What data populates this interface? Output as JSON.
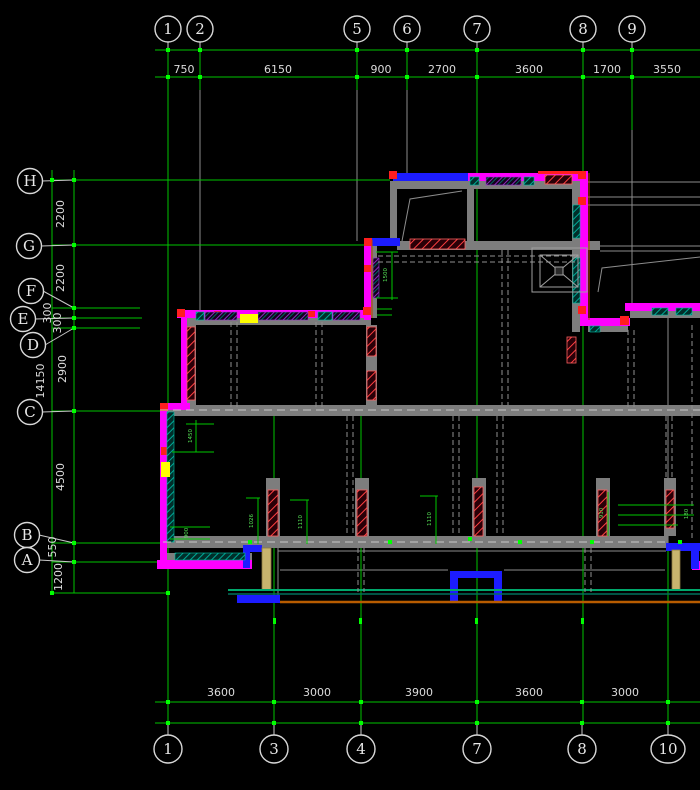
{
  "drawing": {
    "type": "cad-structural-floor-plan",
    "background": "#000000",
    "colors": {
      "grid_green": "#00C400",
      "marker_green": "#00FF00",
      "dim_text": "#DCDCDC",
      "wall_gray": "#7D7D7D",
      "outline_magenta": "#FF00FF",
      "accent_blue": "#1C1CFF",
      "accent_red": "#FF1E1E",
      "hatch_teal": "#00897B",
      "hatch_purple": "#7A00B4",
      "highlight_yellow": "#FFFF00",
      "edge_orange": "#B85C00",
      "door_tan": "#C8B46E"
    },
    "grid": {
      "top_bubbles": [
        {
          "label": "1",
          "x": 168
        },
        {
          "label": "2",
          "x": 200
        },
        {
          "label": "5",
          "x": 357
        },
        {
          "label": "6",
          "x": 407
        },
        {
          "label": "7",
          "x": 477
        },
        {
          "label": "8",
          "x": 583
        },
        {
          "label": "9",
          "x": 632
        }
      ],
      "bottom_bubbles": [
        {
          "label": "1",
          "x": 168
        },
        {
          "label": "3",
          "x": 274
        },
        {
          "label": "4",
          "x": 361
        },
        {
          "label": "7",
          "x": 477
        },
        {
          "label": "8",
          "x": 582
        },
        {
          "label": "10",
          "x": 668
        }
      ],
      "left_bubbles": [
        {
          "label": "H",
          "cx": 30,
          "cy": 181,
          "row_y": 180
        },
        {
          "label": "G",
          "cx": 29,
          "cy": 246,
          "row_y": 245
        },
        {
          "label": "F",
          "cx": 31,
          "cy": 291,
          "row_y": 308
        },
        {
          "label": "E",
          "cx": 23,
          "cy": 319,
          "row_y": 318
        },
        {
          "label": "D",
          "cx": 33,
          "cy": 345,
          "row_y": 328
        },
        {
          "label": "C",
          "cx": 30,
          "cy": 412,
          "row_y": 411
        },
        {
          "label": "B",
          "cx": 27,
          "cy": 535,
          "row_y": 543
        },
        {
          "label": "A",
          "cx": 27,
          "cy": 560,
          "row_y": 562
        }
      ],
      "top_dims": [
        {
          "value": "750",
          "x": 184
        },
        {
          "value": "6150",
          "x": 278
        },
        {
          "value": "900",
          "x": 381
        },
        {
          "value": "2700",
          "x": 442
        },
        {
          "value": "3600",
          "x": 529
        },
        {
          "value": "1700",
          "x": 607
        },
        {
          "value": "3550",
          "x": 667
        }
      ],
      "bottom_dims": [
        {
          "value": "3600",
          "x": 221
        },
        {
          "value": "3000",
          "x": 317
        },
        {
          "value": "3900",
          "x": 419
        },
        {
          "value": "3600",
          "x": 529
        },
        {
          "value": "3000",
          "x": 625
        }
      ],
      "left_dims": [
        {
          "value": "2200",
          "x": 64,
          "y": 214
        },
        {
          "value": "2200",
          "x": 64,
          "y": 278
        },
        {
          "value": "300",
          "x": 51,
          "y": 313
        },
        {
          "value": "300",
          "x": 61,
          "y": 323
        },
        {
          "value": "2900",
          "x": 66,
          "y": 369
        },
        {
          "value": "4500",
          "x": 64,
          "y": 477
        },
        {
          "value": "550",
          "x": 56,
          "y": 547
        },
        {
          "value": "1200",
          "x": 62,
          "y": 577
        }
      ],
      "overall_dim": {
        "value": "14150",
        "x": 44,
        "y": 381
      }
    },
    "small_dims": [
      {
        "value": "1450",
        "x": 192,
        "y": 436,
        "rot": true
      },
      {
        "value": "1500",
        "x": 387,
        "y": 275,
        "rot": true
      },
      {
        "value": "1026",
        "x": 253,
        "y": 521,
        "rot": true
      },
      {
        "value": "1110",
        "x": 302,
        "y": 522,
        "rot": true
      },
      {
        "value": "1110",
        "x": 431,
        "y": 519,
        "rot": true
      },
      {
        "value": "910",
        "x": 603,
        "y": 513,
        "rot": true
      },
      {
        "value": "900",
        "x": 188,
        "y": 533,
        "rot": true
      },
      {
        "value": "180",
        "x": 688,
        "y": 514,
        "rot": true
      }
    ]
  }
}
